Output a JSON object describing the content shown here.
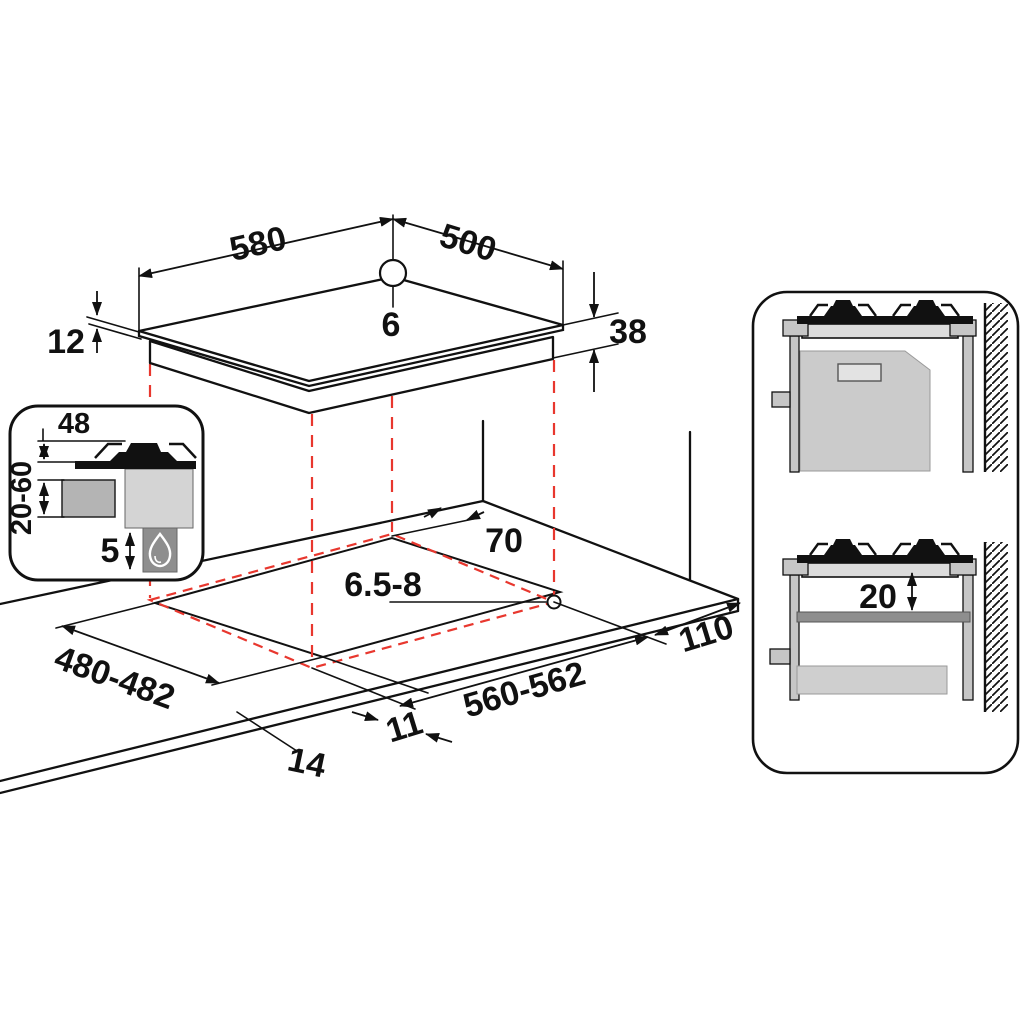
{
  "title": "Gas hob built-in installation dimensions diagram",
  "labels": {
    "hob_width": "580",
    "hob_depth": "500",
    "hole_diameter": "6",
    "glass_thickness": "12",
    "hob_height": "38",
    "wall_clearance": "70",
    "fixing_hole": "6.5-8",
    "side_clearance": "110",
    "cutout_depth": "480-482",
    "cutout_width": "560-562",
    "gap_front": "11",
    "gap_side": "14",
    "inset_burner_height": "48",
    "inset_cabinet_clearance": "20-60",
    "inset_bottom_gap": "5",
    "panel_shelf_clearance": "20"
  },
  "icons": {
    "flame": "flame-icon",
    "wall_hatch": "wall-hatch-icon",
    "screw_hole": "screw-hole-circle",
    "reference_hole": "reference-hole-circle"
  },
  "colors": {
    "projection_red": "#e8372e",
    "line_black": "#111111",
    "light_gray": "#dcdcdc",
    "mid_gray": "#c6c6c6",
    "dark_gray": "#8e8e8e"
  }
}
